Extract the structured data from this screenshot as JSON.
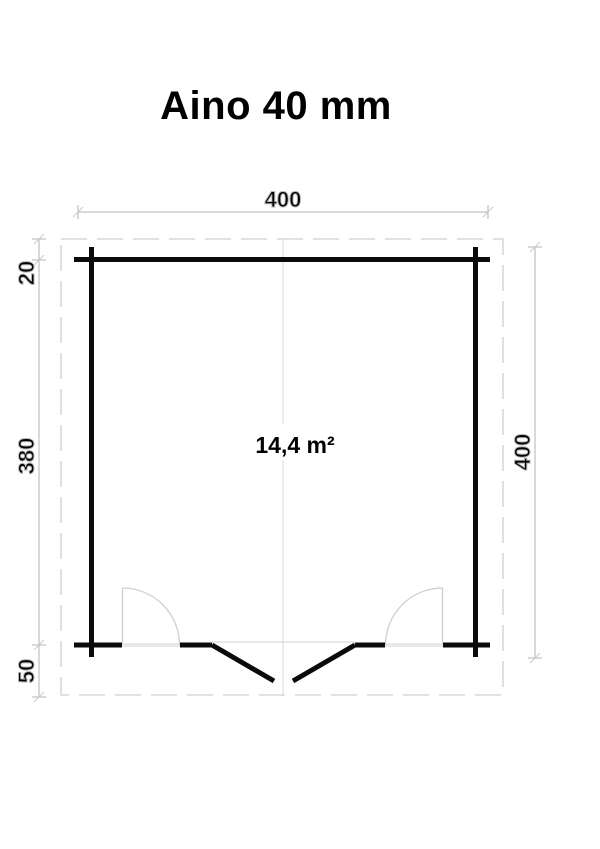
{
  "title": "Aino 40 mm",
  "colors": {
    "wall": "#0b0b0b",
    "dimension": "#b3b3b3"
  },
  "floor_plan": {
    "area_label": "14,4 m²",
    "dimensions": {
      "width_top": "400",
      "depth_right": "400",
      "rear_overhang_left": "20",
      "depth_left": "380",
      "front_overhang_left": "50"
    }
  }
}
